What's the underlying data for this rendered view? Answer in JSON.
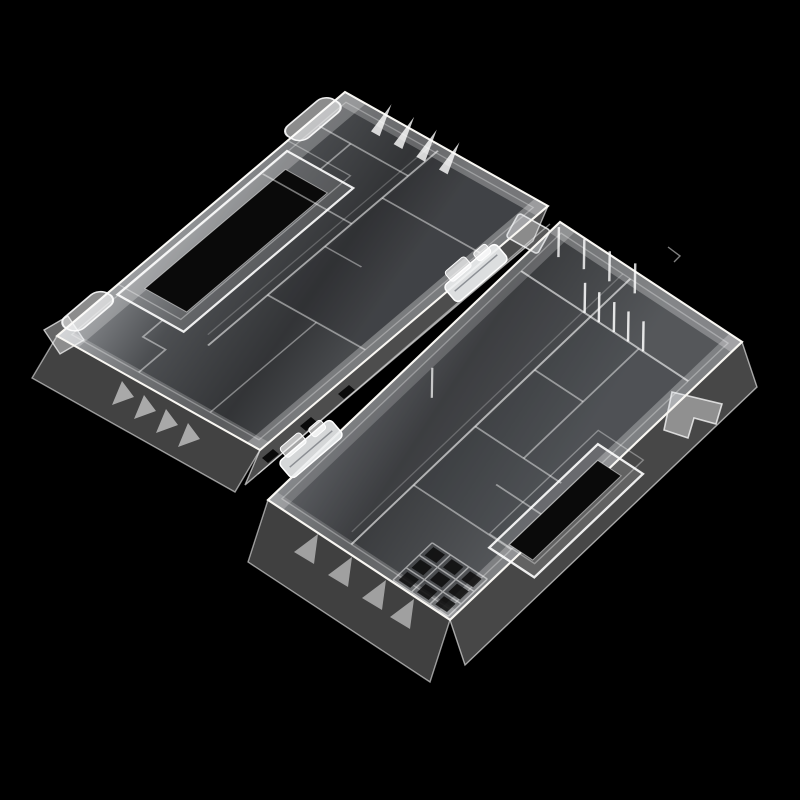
{
  "image": {
    "description": "Product photograph of a translucent white plastic battery storage organizer box shown opened flat into two hinged trays, photographed at an angle on a pure black background",
    "object": "translucent plastic battery storage box, opened",
    "background": "black studio backdrop"
  },
  "colors": {
    "background": "#000000",
    "plastic_edge": "#f8f6f1",
    "plastic_body": "#c9cfd7",
    "floor_shadow": "#46494e",
    "slot_black": "#0a0a0a"
  },
  "parts": {
    "lid": {
      "label": "lid tray (upper left half)",
      "handle_slot": "dark rectangular carry slot in raised bezel",
      "separator_fins": 4,
      "side_fins": 4,
      "flange_slots": 3,
      "hinge_barrels": 2,
      "dividers": 8
    },
    "base": {
      "label": "base tray (lower right half)",
      "latch_slot": "dark rectangular latch slot in raised bezel",
      "tall_divider_fins": 5,
      "edge_fins": 4,
      "channel_fins": 1,
      "grid_cells": 9,
      "wall_gussets": 4,
      "dividers": 8,
      "latch_tab": "protruding side latch tab"
    },
    "hinges": {
      "label": "snap-fit hinge clips on center pin line",
      "count": 2
    }
  }
}
